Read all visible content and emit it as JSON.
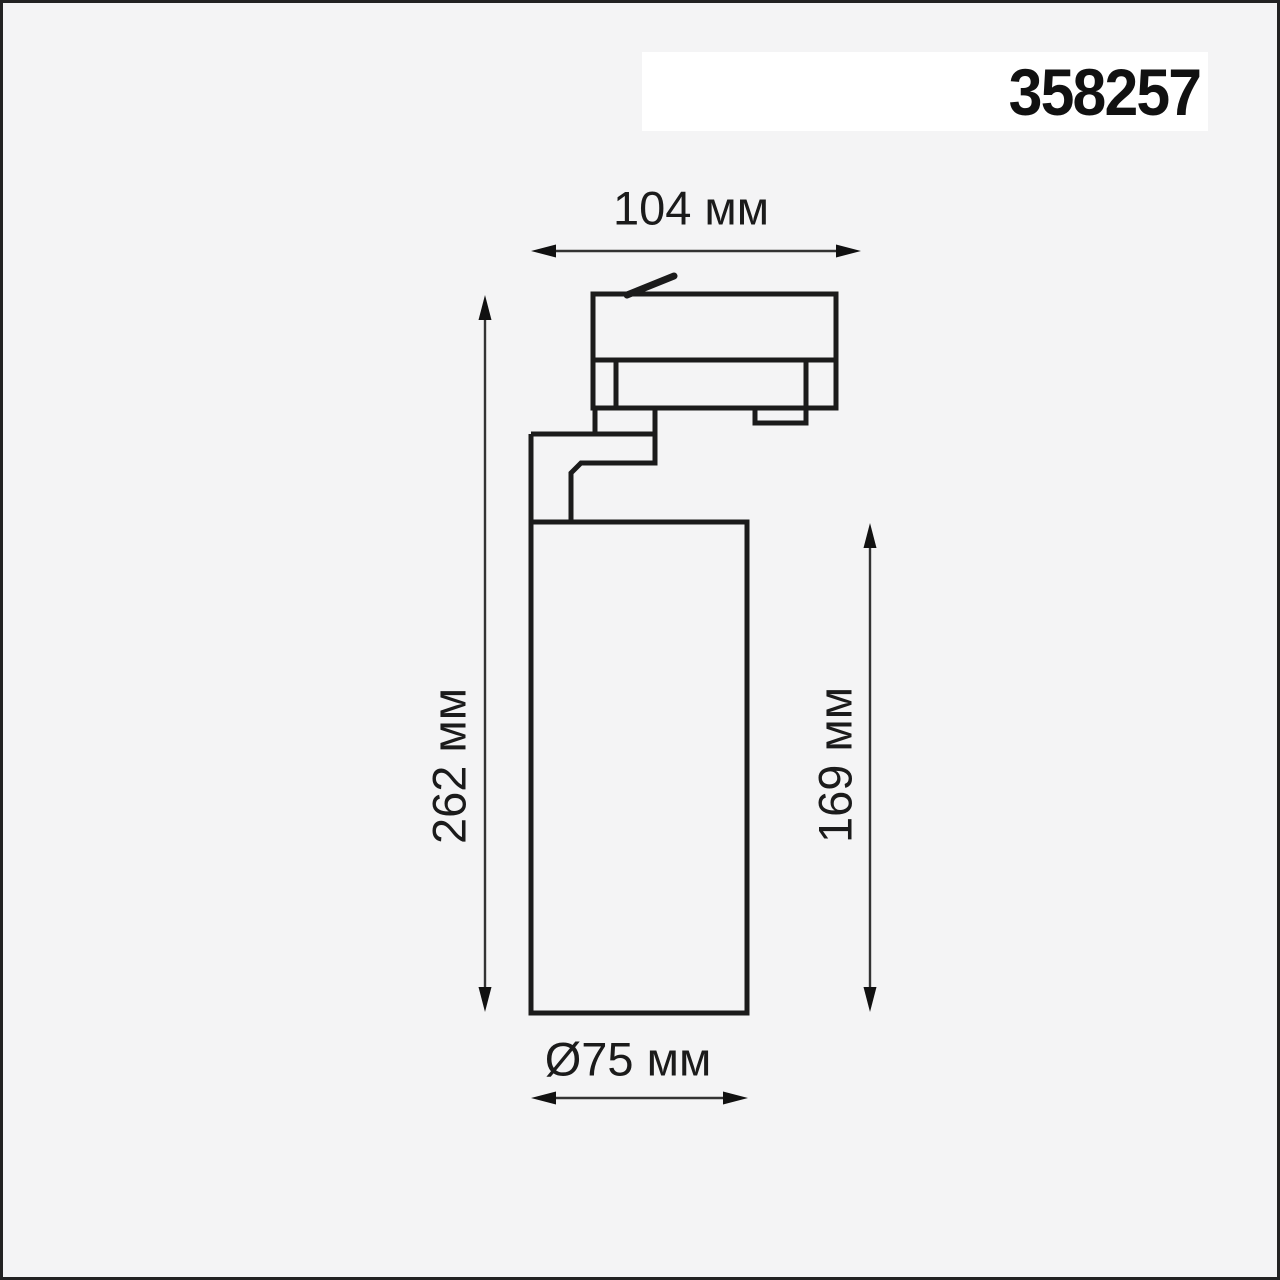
{
  "page": {
    "background_color": "#f4f4f5",
    "frame_color": "#222222"
  },
  "header": {
    "product_code": "358257",
    "band_color": "#ffffff"
  },
  "drawing": {
    "subject": "track-mounted cylindrical spotlight, side elevation with dimensions",
    "line_color": "#1b1b1b",
    "dimensions": {
      "width": {
        "label": "104 мм",
        "value_mm": 104,
        "orientation": "horizontal"
      },
      "overall_height": {
        "label": "262 мм",
        "value_mm": 262,
        "orientation": "vertical"
      },
      "body_height": {
        "label": "169 мм",
        "value_mm": 169,
        "orientation": "vertical"
      },
      "diameter": {
        "label": "Ø75 мм",
        "value_mm": 75,
        "orientation": "horizontal"
      }
    }
  }
}
